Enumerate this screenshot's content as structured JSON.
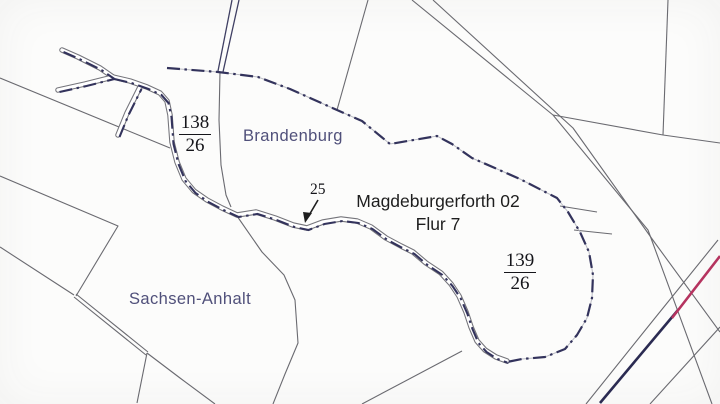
{
  "map": {
    "type": "cadastral-boundary-map",
    "regions": {
      "brandenburg": {
        "label": "Brandenburg"
      },
      "sachsen_anhalt": {
        "label": "Sachsen-Anhalt"
      }
    },
    "title_block": {
      "line1": "Magdeburgerforth 02",
      "line2": "Flur 7"
    },
    "parcels": {
      "p138": {
        "numerator": "138",
        "denominator": "26"
      },
      "p139": {
        "numerator": "139",
        "denominator": "26"
      },
      "p25": {
        "label": "25"
      }
    },
    "colors": {
      "background": "#fcfcfb",
      "parcel_line_grey": "#6a6a70",
      "state_boundary_navy": "#33335c",
      "railway_navy": "#2b2b52",
      "railway_red": "#b5335f",
      "state_label_blue": "#50507a",
      "black_text": "#1e1e1e"
    }
  }
}
